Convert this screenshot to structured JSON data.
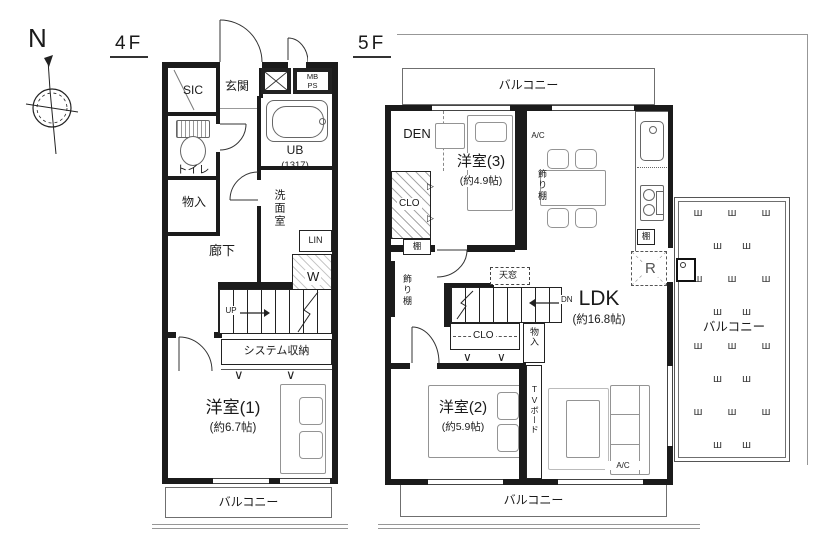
{
  "compass": {
    "n": "N"
  },
  "icons": {
    "grass": "ш"
  },
  "colors": {
    "wall": "#1b1b1b",
    "line": "#444444",
    "furniture": "#949494"
  },
  "f4": {
    "title": "4F",
    "sic": "SIC",
    "genkan": "玄関",
    "mbps": "MB\nPS",
    "toilet": "トイレ",
    "ub": "UB",
    "ub_size": "(1317)",
    "senmen": "洗面室",
    "lin": "LIN",
    "w": "W",
    "monoire": "物入",
    "rouka": "廊下",
    "up": "UP",
    "syscl": "システム収納",
    "room1": "洋室(1)",
    "room1_size": "(約6.7帖)",
    "balcony": "バルコニー"
  },
  "f5": {
    "title": "5F",
    "balcony_top": "バルコニー",
    "den": "DEN",
    "clo1": "CLO",
    "shelf_left": "棚",
    "room3": "洋室(3)",
    "room3_size": "(約4.9帖)",
    "ac_top": "A/C",
    "kazari_right": "飾り棚",
    "kazari_left": "飾り棚",
    "shelf_kitchen": "棚",
    "fridge": "R",
    "tenmado": "天窓",
    "dn": "DN",
    "clo2": "CLO",
    "monoire": "物入",
    "ldk": "LDK",
    "ldk_size": "(約16.8帖)",
    "room2": "洋室(2)",
    "room2_size": "(約5.9帖)",
    "tv": "TVボード",
    "ac_bottom": "A/C",
    "balcony_bottom": "バルコニー",
    "roof_balcony": "バルコニー"
  }
}
